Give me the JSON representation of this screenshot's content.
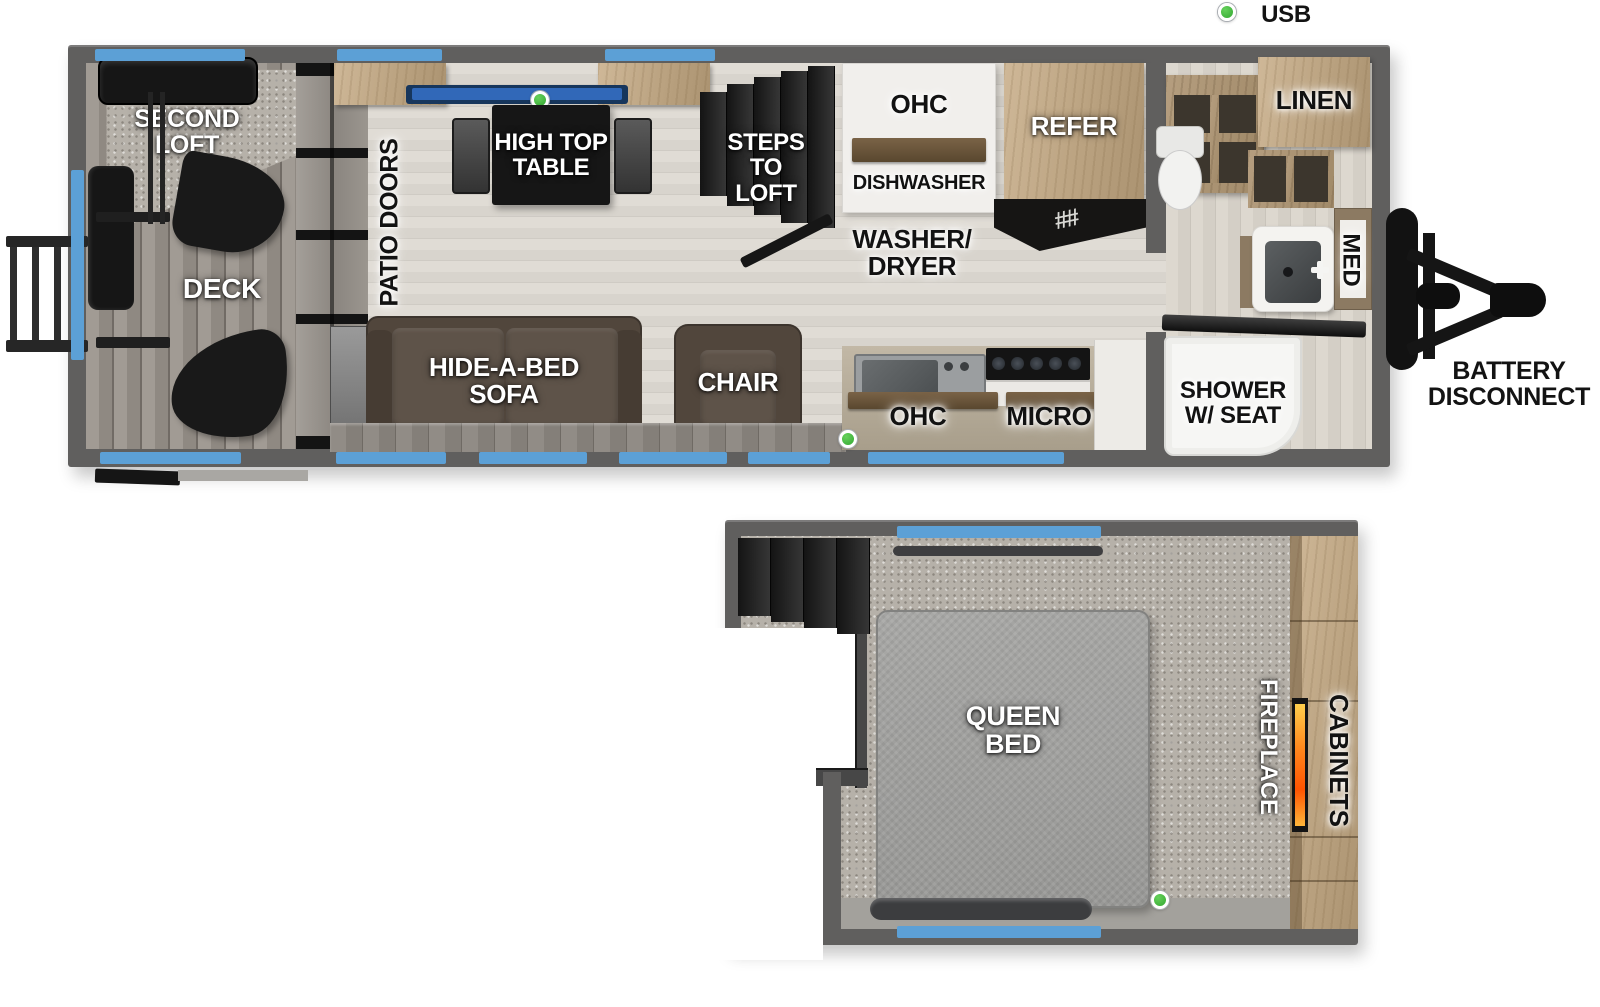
{
  "legend": {
    "usb": "USB"
  },
  "colors": {
    "usb_green": "#3db539",
    "window_blue": "#5ca0d6",
    "wall_grey": "#605f5e",
    "cabinet_wood": "#bda684",
    "sofa_brown": "#51463c",
    "bench_blue": "#3168b8"
  },
  "main_floor": {
    "second_loft": "SECOND\nLOFT",
    "deck": "DECK",
    "patio_doors": "PATIO DOORS",
    "high_top_table": "HIGH TOP\nTABLE",
    "steps_to_loft": "STEPS\nTO\nLOFT",
    "ohc_dinette": "OHC",
    "dishwasher": "DISHWASHER",
    "washer_dryer": "WASHER/\nDRYER",
    "refer": "REFER",
    "fork_icon": "##",
    "hide_a_bed_sofa": "HIDE-A-BED\nSOFA",
    "chair": "CHAIR",
    "ohc_kitchen": "OHC",
    "micro": "MICRO",
    "linen": "LINEN",
    "med": "MED",
    "shower_w_seat": "SHOWER\nW/ SEAT",
    "battery_disconnect": "BATTERY\nDISCONNECT"
  },
  "loft": {
    "queen_bed": "QUEEN\nBED",
    "fireplace": "FIREPLACE",
    "cabinets": "CABINETS"
  }
}
